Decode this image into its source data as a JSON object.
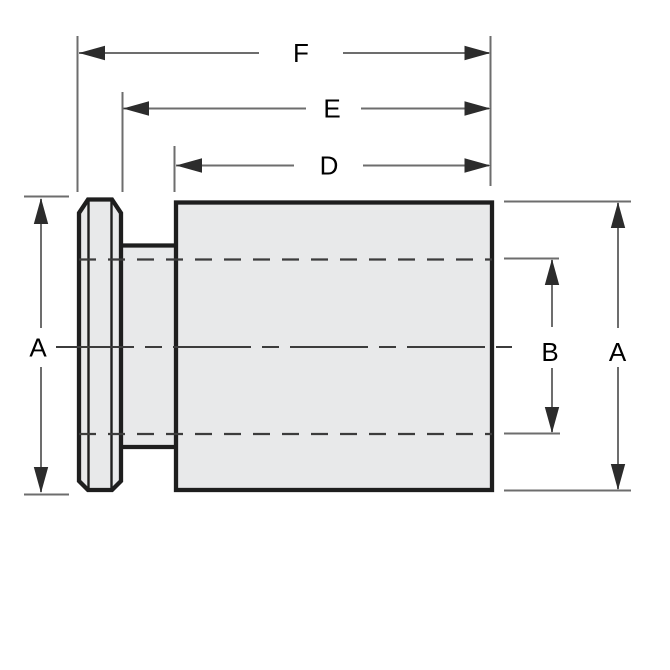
{
  "drawing": {
    "kind": "technical-dimension-drawing",
    "dimensions": {
      "f": {
        "label": "F"
      },
      "e": {
        "label": "E"
      },
      "d": {
        "label": "D"
      },
      "a_left": {
        "label": "A"
      },
      "b": {
        "label": "B"
      },
      "a_right": {
        "label": "A"
      }
    },
    "colors": {
      "background": "#ffffff",
      "part_fill": "#e8e9ea",
      "part_outline": "#1e1e1e",
      "hidden_line": "#3c3c3c",
      "dimension_line": "#6d6d6d",
      "arrowhead": "#2c2c2c",
      "label_text": "#000000"
    }
  }
}
